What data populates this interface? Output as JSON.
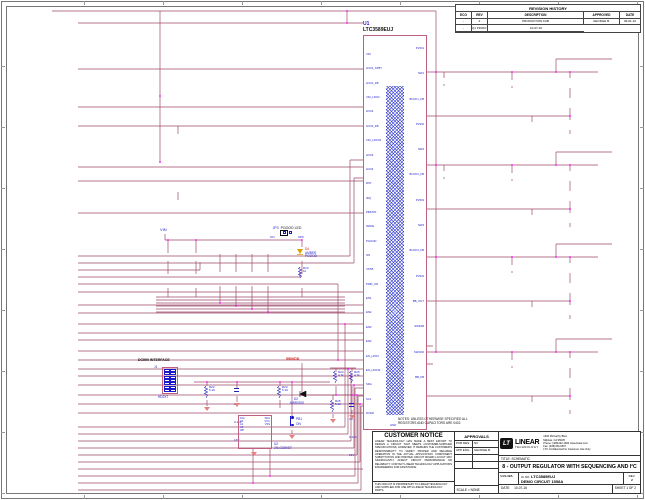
{
  "colors": {
    "wire": "#9c4a6a",
    "net_label": "#cc1111",
    "component": "#2020b8",
    "junction": "#ff00ff",
    "gnd_symbol": "#e98080"
  },
  "sheet": {
    "notes": "NOTES: UNLESS OTHERWISE SPECIFIED ALL\nRESISTORS AND CAPACITORS ARE 0402."
  },
  "rev": {
    "title": "REVISION HISTORY",
    "cols": [
      {
        "v": "ECO"
      },
      {
        "v": "REV"
      },
      {
        "v": "DESCRIPTION"
      },
      {
        "v": "APPROVED"
      },
      {
        "v": "DATE"
      }
    ],
    "rows": [
      {
        "c0": "-",
        "c1": "2",
        "c2": "PRODUCTION FAB",
        "c3": "GEORGE B.",
        "c4": "09-01-10"
      },
      {
        "c0": "-",
        "c1": "",
        "c2": "Q1 PINOUT MATCHES VENDOR DS, NO PCB CHANGE",
        "c3": "",
        "c4": "10-07-16"
      }
    ]
  },
  "left_rows": [
    {
      "net": "VIN"
    },
    {
      "e": "E1",
      "label": "VIN",
      "sub1": "2.7V - 5.5V",
      "sub2": "2A"
    },
    {
      "e": "E2",
      "label": "GND",
      "gnd": 1
    },
    {
      "net": "VLDO1"
    },
    {
      "e": "E3",
      "label": "VRTC(LDO1)",
      "sub1": "1.2V",
      "sub2": "25mA"
    },
    {
      "e": "E4",
      "label": "GND",
      "gnd": 1
    },
    {
      "e": "E5",
      "label": "VIN_LDO2",
      "sub1": "1.8V - 5.5V"
    },
    {
      "e": "E6",
      "label": "VMEM(LDO2)",
      "sub1": "0.647V - 1.299V - 1.34V",
      "sub2": "200mA"
    },
    {
      "e": "E7",
      "label": "GND",
      "gnd": 1
    },
    {
      "net": "VLDO2"
    },
    {
      "e": "E8",
      "label": "VIN_LDO34",
      "sub1": "1.5V - 5.5V"
    },
    {
      "e": "E9",
      "label": "VANALOG(LDO3)",
      "sub1": "1.8V",
      "sub2": "200mA"
    },
    {
      "e": "E10",
      "label": "GND",
      "gnd": 1
    },
    {
      "e": "E11",
      "label": "VAUX(LDO4)",
      "sub1": "1.8V, 2.5V, 2.8V, 3.3V",
      "sub2": "200mA"
    },
    {
      "e": "E12",
      "label": "GND",
      "gnd": 1
    }
  ],
  "mid_nets": [
    {
      "label": "VLDO3"
    },
    {
      "label": "VLDO4"
    },
    {
      "label": "IRQ",
      "ov": 1
    },
    {
      "label": "PGOOD"
    },
    {
      "label": "PWR_ON"
    }
  ],
  "controls": [
    {
      "e": "E13",
      "label": "RST",
      "ov": 1
    },
    {
      "e": "E14",
      "label": "IRQ",
      "ov": 1,
      "res": "R11 10k"
    },
    {
      "e": "E15",
      "label": "PBSTAT"
    },
    {
      "e": "E16",
      "label": "WAKE",
      "res": "R12 10k"
    },
    {
      "e": "E17",
      "label": "PGOOD",
      "res": "R13 10k"
    },
    {
      "e": "E18",
      "label": "ON",
      "ov": 1
    },
    {
      "e": "E19",
      "label": "VSTB",
      "res": "R14 10k"
    },
    {
      "e": "E20",
      "label": "PWR_ON",
      "res": "R15 10k"
    },
    {
      "e": "E21",
      "label": "EN1",
      "res": "R16 10k"
    },
    {
      "e": "E22",
      "label": "EN2",
      "res": "R17 10k"
    },
    {
      "e": "E23",
      "label": "EN3",
      "res": "R18 10k"
    },
    {
      "e": "E24",
      "label": "EN4",
      "res": "R19 10k"
    },
    {
      "e": "E25",
      "label": "EN_LDO2",
      "res": "R20 10k"
    },
    {
      "e": "E26",
      "label": "EN_LDO34",
      "res": "R21 10k"
    }
  ],
  "bottom_nets": [
    {
      "label": "WAKE"
    },
    {
      "label": "EN1"
    },
    {
      "label": "EN2"
    },
    {
      "label": "EN3"
    },
    {
      "label": "EN4"
    },
    {
      "label": "EN_LDO2"
    },
    {
      "label": "EN_LDO34"
    },
    {
      "label": "SDA"
    },
    {
      "label": "SCL"
    },
    {
      "label": "DVDD"
    }
  ],
  "jumpers": [
    {
      "jp": "JP1",
      "name": "LDO2VIN",
      "opt1": "VIN",
      "opt2": "VSRAM",
      "sub1": "VIN",
      "sub2": "VSRAM(B2)",
      "ext": "EXT"
    },
    {
      "jp": "JP2",
      "name": "LDO34VIN",
      "opt1": "VIN",
      "opt2": "VIO",
      "sub1": "VIN",
      "sub2": "VIO(BB)",
      "ext": "EXT"
    }
  ],
  "led_section": {
    "vin": "VIN",
    "leds": [
      {
        "ref": "D3",
        "color": "RED",
        "sig": "RST",
        "ov": 1,
        "res": "R5\n1k"
      },
      {
        "ref": "D1",
        "color": "RED",
        "sig": "IRQ",
        "ov": 1,
        "res": "R3\n1k"
      }
    ],
    "pulls": [
      {
        "v": "R6\n100k"
      },
      {
        "v": "R7\n100k"
      },
      {
        "v": "R8\n100k"
      },
      {
        "v": "R9\n100k"
      }
    ],
    "jp": {
      "ref": "JP3",
      "name": "PGOOD LED",
      "on": "ON",
      "off": "OFF"
    },
    "amber": {
      "ref": "D4",
      "color": "AMBER",
      "sig": "PGOOD",
      "res": "R10\n1k"
    }
  },
  "dc590": {
    "title": "DC590 INTERFACE",
    "j_ref": "J1",
    "j_part": "HD2X7",
    "r22": "R22\n5.1K",
    "c8": "C8\n0.1uF\n16V",
    "r23": "R23\n5.1K",
    "u2_ref": "U2",
    "u2_part": "24LC025/ST",
    "u2_left": "SCL\nA0\nA1\nA2\nWP",
    "u2_right": "SDA\nVCC\nVSS",
    "pb_ref": "PB1",
    "pb_label": "ON",
    "d_ref": "D2",
    "d_part": "MBR0520",
    "net590": "590VDD",
    "r24": "R24\n4.7k",
    "r26": "R26\n4.7k",
    "r25": "R25\n5.1K",
    "c9": "C9\n0.1uF\n16V"
  },
  "ic": {
    "refdes": "U1",
    "part": "LTC3589EUJ",
    "gnd_pin": "GND",
    "left_pins": [
      {
        "v": "VIN"
      },
      {
        "v": "LDO1_STBY"
      },
      {
        "v": "LDO1_FB"
      },
      {
        "v": "VIN_LDO2"
      },
      {
        "v": "LDO2"
      },
      {
        "v": "LDO2_FB"
      },
      {
        "v": "VIN_LDO34"
      },
      {
        "v": "LDO3"
      },
      {
        "v": "LDO4"
      },
      {
        "v": "RST"
      },
      {
        "v": "IRQ"
      },
      {
        "v": "PBSTAT"
      },
      {
        "v": "WAKE"
      },
      {
        "v": "PGOOD"
      },
      {
        "v": "ON"
      },
      {
        "v": "VSTB"
      },
      {
        "v": "PWR_ON"
      },
      {
        "v": "EN1"
      },
      {
        "v": "EN2"
      },
      {
        "v": "EN3"
      },
      {
        "v": "EN4"
      },
      {
        "v": "EN_LDO2"
      },
      {
        "v": "EN_LDO34"
      },
      {
        "v": "SDA"
      },
      {
        "v": "SCL"
      },
      {
        "v": "DVDD"
      }
    ],
    "right_pins": [
      {
        "v": "PVIN1"
      },
      {
        "v": "SW1"
      },
      {
        "v": "BUCK1_FB"
      },
      {
        "v": "PVIN2"
      },
      {
        "v": "SW2"
      },
      {
        "v": "BUCK2_FB"
      },
      {
        "v": "PVIN3"
      },
      {
        "v": "SW3"
      },
      {
        "v": "BUCK3_FB"
      },
      {
        "v": "PVIN4"
      },
      {
        "v": "BB_OUT"
      },
      {
        "v": "SW4AB"
      },
      {
        "v": "SW4CD"
      },
      {
        "v": "BB_FB"
      }
    ]
  },
  "outputs": [
    {
      "net": "VBUCK1",
      "cin": "C21\n10uF\n0603\n6.3V\n20%",
      "l_ref": "L4",
      "l_val": "1.0uH",
      "l_part": "XFL4020-102ML",
      "cout": "C19\n22uF\n6.3V\n20%\n0805",
      "cfb": "C18\n10pF\n±0.5pF",
      "rs": "R34\n20",
      "tp": "TP4",
      "tpn": "FB1",
      "rm": "R37\n634k\n1%",
      "rb": "R36\n768k\n1%",
      "e": "E34",
      "name": "VCORE(B1)",
      "range": "0.647V - 1.299V - 1.34V",
      "amps": "1.6A",
      "ge": "E33",
      "gnd": "GND"
    },
    {
      "net": "VBUCK2",
      "pre": "VSRAM",
      "cin": "C17\n10uF\n0603\n6.3V\n20%",
      "l_ref": "L3",
      "l_val": "1.0uH",
      "l_part": "XFL4020-102ML",
      "cout": "C16\n22uF\n6.3V\n20%\n0805",
      "cfb": "C15\n10pF\n±0.5pF",
      "rs": "R35\n20",
      "tp": "TP3",
      "tpn": "FB2",
      "rm": "715k\n1%",
      "rb": "432k\n1%",
      "e": "E32",
      "name": "VSRAM(B2)",
      "range": "0.677V - 1.819V - 2.62V",
      "amps": "1.6A",
      "ge": "E31",
      "gnd": "GND"
    },
    {
      "net": "VBUCK3",
      "cin": "",
      "l_ref": "L2",
      "l_val": "1.0uH",
      "l_part": "XFL4020-102ML",
      "cout": "C13\n22uF\n6.3V\n20%\n0805",
      "cfb": "C12\n10pF\n±0.5pF",
      "rs": "R33\n20",
      "tp": "TP2",
      "tpn": "FB3",
      "rm": "R31\n887k\n1%",
      "rb": "R30\n787k\n1%",
      "e": "E30",
      "name": "VIOC(B3)",
      "range": "0.62V - 1.29V - 1.39V",
      "amps": "1.0A",
      "ge": "E29",
      "gnd": "GND"
    },
    {
      "net": "VBuckBoost",
      "pre": "VD",
      "cin": "",
      "l_ref": "L1",
      "l_val": "",
      "l_part": "",
      "cout": "C10\n22uF\n6.3V\n20%\n0805",
      "cfb": "C22\n4.7pF\n±0.5pF",
      "rs": "R29\n20",
      "tp": "TP1",
      "tpn": "FBB",
      "rm": "R28\n1MEG\n1%",
      "rb": "R27\n316k\n1%",
      "e": "E28",
      "name": "VIO(BB)",
      "range": "3.3V",
      "amps": "1.2A",
      "ge": "E27",
      "gnd": "GND"
    }
  ],
  "tb": {
    "notice_title": "CUSTOMER NOTICE",
    "notice_body": "LINEAR TECHNOLOGY HAS MADE A BEST EFFORT TO DESIGN A CIRCUIT THAT MEETS CUSTOMER-SUPPLIED SPECIFICATIONS; HOWEVER, IT REMAINS THE CUSTOMER'S RESPONSIBILITY TO VERIFY PROPER AND RELIABLE OPERATION IN THE ACTUAL APPLICATION. COMPONENT SUBSTITUTION AND PRINTED CIRCUIT BOARD LAYOUT MAY SIGNIFICANTLY AFFECT CIRCUIT PERFORMANCE OR RELIABILITY. CONTACT LINEAR TECHNOLOGY APPLICATIONS ENGINEERING FOR ASSISTANCE.",
    "proprietary": "THIS CIRCUIT IS PROPRIETARY TO LINEAR TECHNOLOGY AND SUPPLIED FOR USE WITH LINEAR TECHNOLOGY PARTS.",
    "approvals": "APPROVALS",
    "pcb_des_label": "PCB DES.",
    "pcb_des": "NC",
    "app_eng_label": "APP ENG.",
    "app_eng": "GEORGE B.",
    "scale": "SCALE = NONE",
    "company1": "LINEAR",
    "company2": "TECHNOLOGY",
    "logo_mark": "LT",
    "addr1": "1630 McCarthy Blvd.",
    "addr2": "Milpitas, CA 95035",
    "addr3": "Phone: (408)432-1900   www.linear.com",
    "addr4": "Fax: (408)434-0507",
    "addr5": "LTC Confidential-For Customer Use Only",
    "title_label": "TITLE:  SCHEMATIC",
    "title_main": "8 - OUTPUT REGULATOR WITH SEQUENCING AND I²C",
    "size_label": "SIZE",
    "size": "N/A",
    "icno_label": "IC NO.",
    "icno": "LTC3589EUJ",
    "circuit": "DEMO CIRCUIT 1558A",
    "rev_label": "REV.",
    "rev": "2",
    "date_label": "DATE:",
    "date": "10-07-16",
    "sheet": "SHEET  1  OF  2"
  }
}
